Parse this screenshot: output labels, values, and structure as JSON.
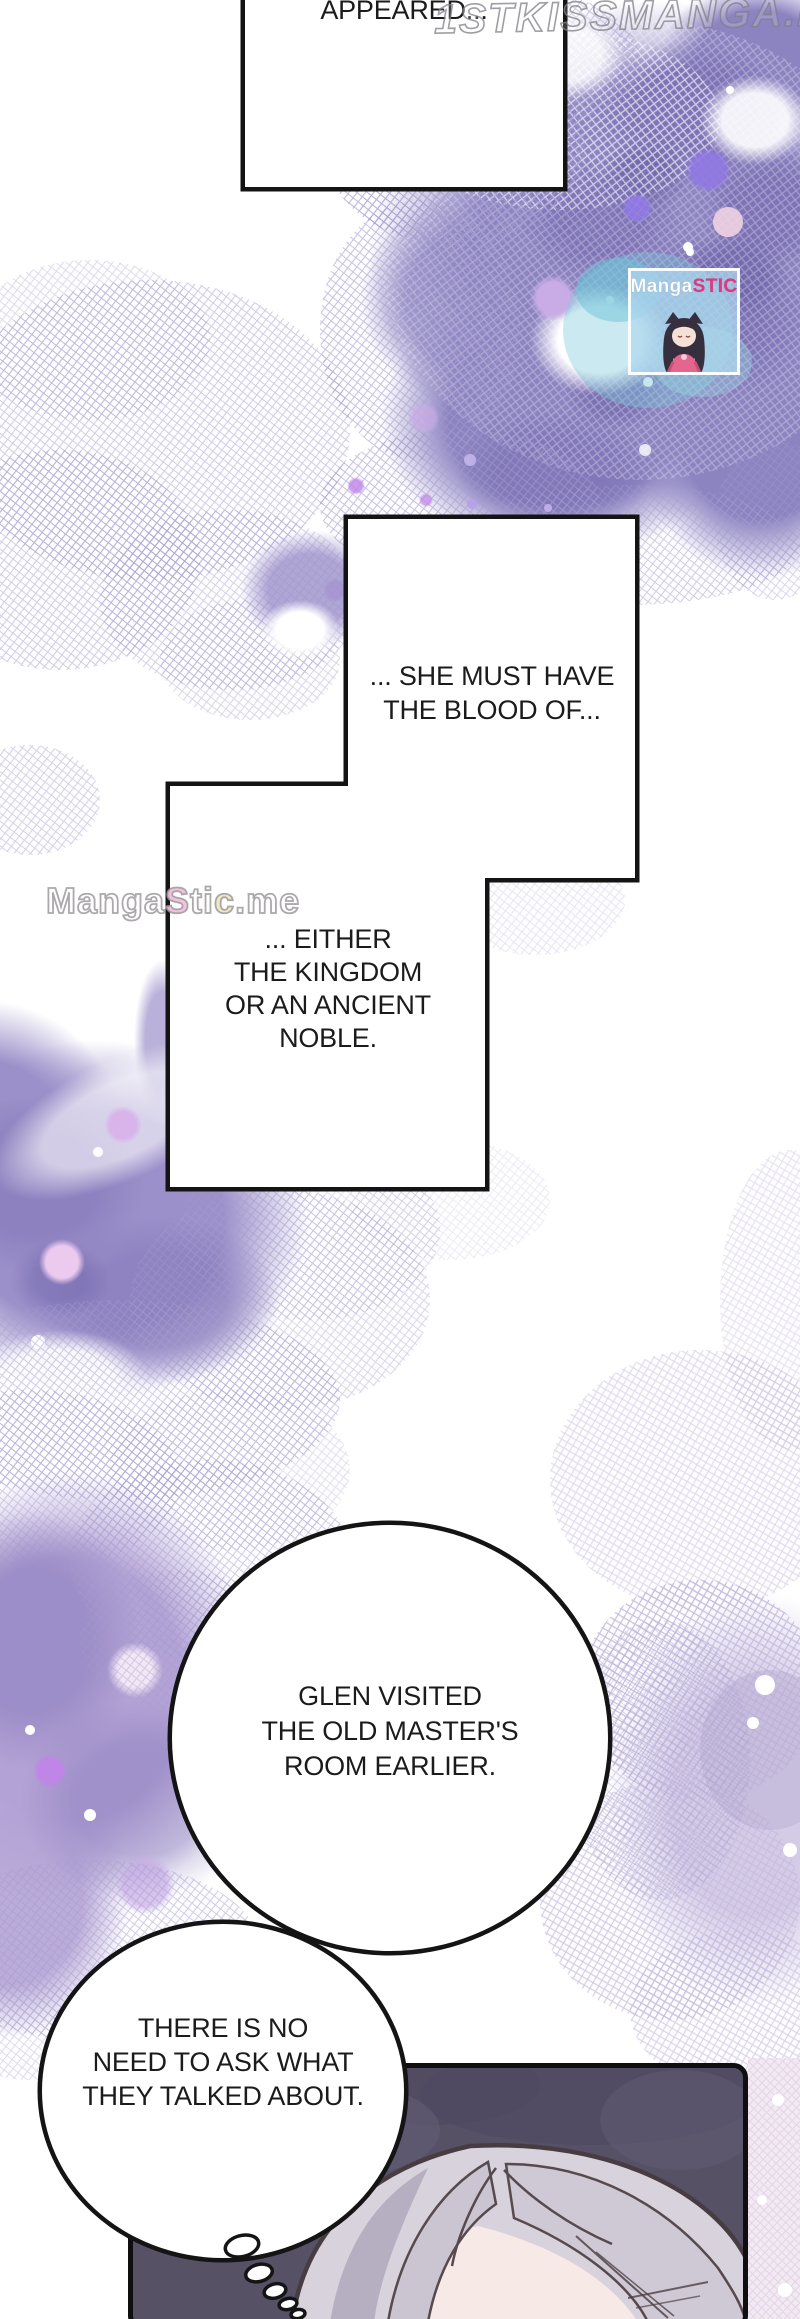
{
  "page": {
    "width": 800,
    "height": 2319
  },
  "dialogue": {
    "appeared": {
      "text": "APPEARED..."
    },
    "blood": {
      "text": "... SHE MUST HAVE\nTHE BLOOD OF..."
    },
    "noble": {
      "text": "... EITHER\nTHE KINGDOM\nOR AN ANCIENT\nNOBLE."
    },
    "glen": {
      "text": "GLEN VISITED\nTHE OLD MASTER'S\nROOM EARLIER."
    },
    "ask": {
      "text": "THERE IS NO\nNEED TO ASK WHAT\nTHEY TALKED ABOUT."
    }
  },
  "watermarks": {
    "top_text": "1STKISSMANGA.IO",
    "site_segments": [
      {
        "t": "Manga",
        "c": "#ffffff"
      },
      {
        "t": "S",
        "c": "#f2bfdb"
      },
      {
        "t": "ti",
        "c": "#ffffff"
      },
      {
        "t": "c",
        "c": "#efe8c0"
      },
      {
        "t": ".me",
        "c": "#ffffff"
      }
    ],
    "badge_title_segments": [
      {
        "t": "Manga",
        "c": "#ffffff"
      },
      {
        "t": "STIC",
        "c": "#e8357f"
      }
    ]
  },
  "colors": {
    "page_bg": "#ffffff",
    "ink": "#1b1b1b",
    "line": "#141414",
    "panel_fill": "#575166",
    "cloud_purple": "#8c83c1",
    "watercolor_mid": "#9c90ca",
    "watercolor_low": "#b3a2d5",
    "right_cloud": "#c6badf",
    "bokeh_violet": "#9077e2",
    "hair_light": "#d8d2dc",
    "hair_shade": "#b3abbf",
    "hair_outline": "#473c41",
    "skin": "#f6e9e6",
    "badge_bg": "#afd8ee",
    "stic_pink": "#e8357f"
  }
}
